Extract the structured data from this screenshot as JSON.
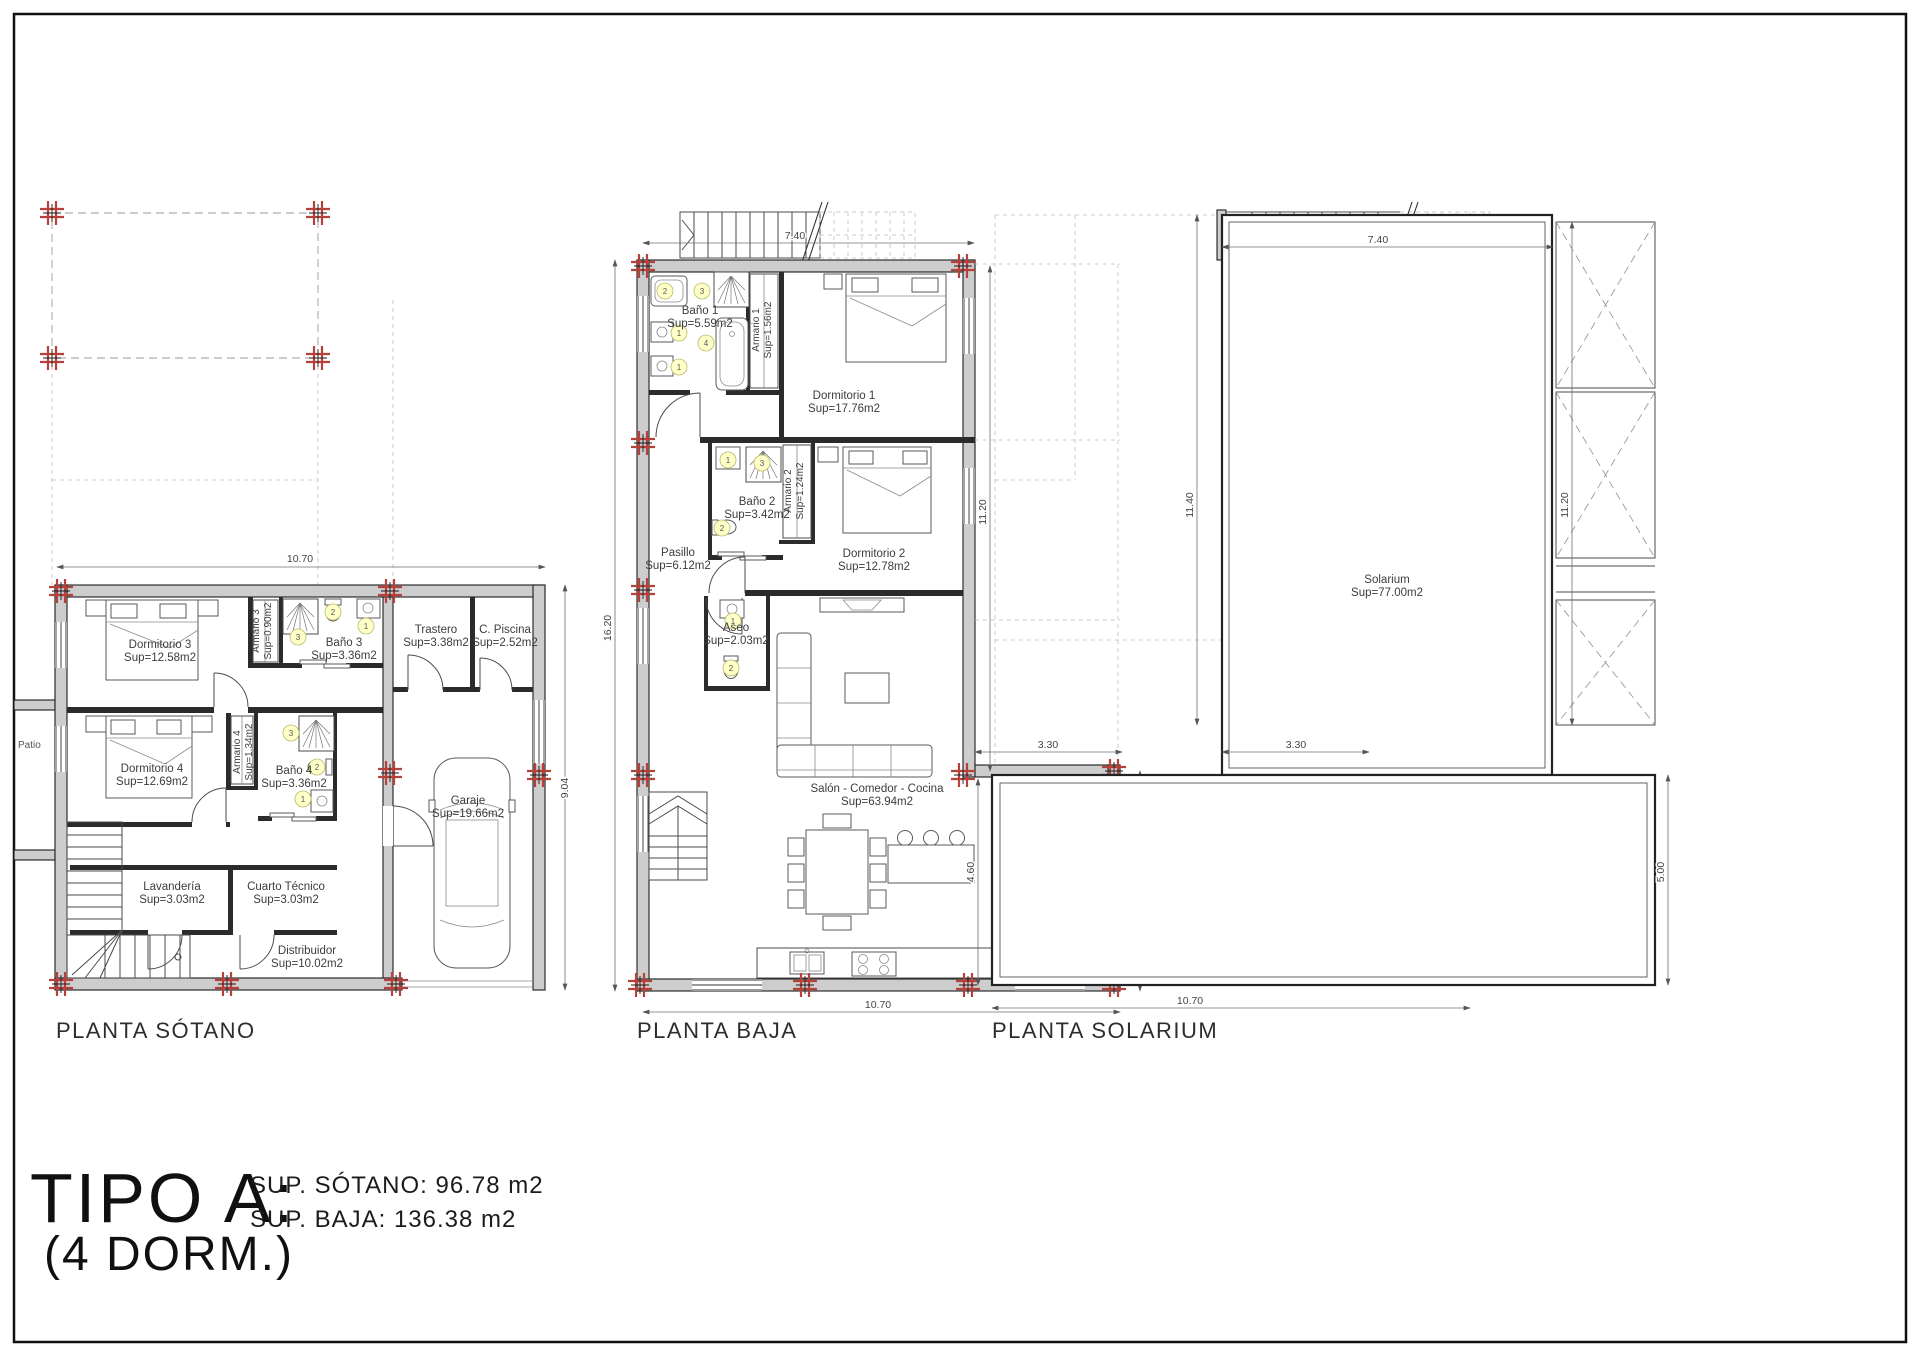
{
  "title_block": {
    "type_label": "TIPO A:",
    "dorm_label": "(4 DORM.)",
    "sup_sotano": "SUP. SÓTANO: 96.78 m2",
    "sup_baja": "SUP. BAJA: 136.38 m2"
  },
  "colors": {
    "column_marker_red": "#b5413a",
    "fixture_marker_yellow": "#ffffc8",
    "wall_gray": "#cdcdcd"
  },
  "plans": {
    "sotano": {
      "title": "PLANTA SÓTANO",
      "rooms": {
        "dormitorio3": {
          "name": "Dormitorio 3",
          "area": "Sup=12.58m2"
        },
        "armario3": {
          "name": "Armario 3",
          "area": "Sup=0.90m2"
        },
        "bano3": {
          "name": "Baño 3",
          "area": "Sup=3.36m2"
        },
        "trastero": {
          "name": "Trastero",
          "area": "Sup=3.38m2"
        },
        "cpiscina": {
          "name": "C. Piscina",
          "area": "Sup=2.52m2"
        },
        "dormitorio4": {
          "name": "Dormitorio 4",
          "area": "Sup=12.69m2"
        },
        "armario4": {
          "name": "Armario 4",
          "area": "Sup=1.34m2"
        },
        "bano4": {
          "name": "Baño 4",
          "area": "Sup=3.36m2"
        },
        "garaje": {
          "name": "Garaje",
          "area": "Sup=19.66m2"
        },
        "lavanderia": {
          "name": "Lavandería",
          "area": "Sup=3.03m2"
        },
        "cuarto_tecnico": {
          "name": "Cuarto Técnico",
          "area": "Sup=3.03m2"
        },
        "distribuidor": {
          "name": "Distribuidor",
          "area": "Sup=10.02m2"
        },
        "patio": {
          "name": "Patio"
        }
      },
      "dims": {
        "width": "10.70",
        "height": "9.04"
      }
    },
    "baja": {
      "title": "PLANTA BAJA",
      "rooms": {
        "bano1": {
          "name": "Baño 1",
          "area": "Sup=5.59m2"
        },
        "armario1": {
          "name": "Armario 1",
          "area": "Sup=1.56m2"
        },
        "dormitorio1": {
          "name": "Dormitorio 1",
          "area": "Sup=17.76m2"
        },
        "bano2": {
          "name": "Baño 2",
          "area": "Sup=3.42m2"
        },
        "armario2": {
          "name": "Armario 2",
          "area": "Sup=1.24m2"
        },
        "dormitorio2": {
          "name": "Dormitorio 2",
          "area": "Sup=12.78m2"
        },
        "pasillo": {
          "name": "Pasillo",
          "area": "Sup=6.12m2"
        },
        "aseo": {
          "name": "Aseo",
          "area": "Sup=2.03m2"
        },
        "salon": {
          "name": "Salón - Comedor - Cocina",
          "area": "Sup=63.94m2"
        }
      },
      "dims": {
        "top": "7.40",
        "left": "16.20",
        "right_upper": "11.20",
        "ext": "3.30",
        "right_lower": "5.00",
        "bottom": "10.70"
      }
    },
    "solarium": {
      "title": "PLANTA SOLARIUM",
      "rooms": {
        "solarium": {
          "name": "Solarium",
          "area": "Sup=77.00m2"
        }
      },
      "dims": {
        "top": "7.40",
        "left": "11.40",
        "inner": "11.20",
        "ext": "3.30",
        "left_lower": "4.60",
        "right_lower": "5.00",
        "bottom": "10.70"
      }
    }
  },
  "markers": {
    "sotano_bano3": [
      "2",
      "1",
      "3"
    ],
    "sotano_bano4": [
      "3",
      "2",
      "1"
    ],
    "baja_bano1": [
      "2",
      "3",
      "1",
      "4",
      "1"
    ],
    "baja_bano2": [
      "1",
      "3",
      "2"
    ],
    "baja_aseo": [
      "1",
      "2"
    ]
  }
}
